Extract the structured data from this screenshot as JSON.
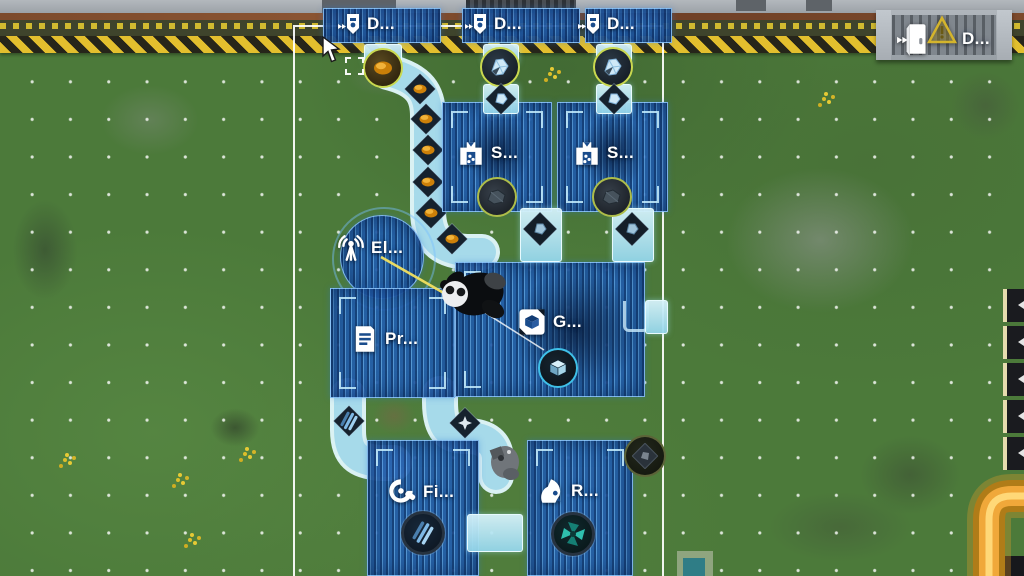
{
  "scene": {
    "view": "factory-blueprint-placement",
    "mode": "blueprint-ghost"
  },
  "labels": {
    "drill_1": "D...",
    "drill_2": "D...",
    "drill_3": "D...",
    "door": "D...",
    "smelter_1": "S...",
    "smelter_2": "S...",
    "electric_pole": "El...",
    "printer": "Pr...",
    "assembler": "G...",
    "fitter": "Fi...",
    "refinery": "R..."
  },
  "icons": {
    "drill": "drill-icon",
    "smelter": "furnace-icon",
    "electric_pole": "antenna-icon",
    "printer": "document-icon",
    "assembler": "cube-transfer-icon",
    "fitter": "gear-icon",
    "refinery": "refine-icon",
    "door": "door-icon",
    "warning": "warning-triangle-icon",
    "cursor": "pointer-cursor-icon"
  },
  "items": {
    "gold_ore": "gold-ore",
    "crystal_ore": "crystal-ore",
    "dark_ingot": "dark-ingot",
    "cube_part": "blue-cube",
    "rods": "blue-rods",
    "fan": "teal-fan"
  },
  "colors": {
    "blueprint_blue": "#2e6cb8",
    "belt_cyan": "#b9e6f2",
    "selection_white": "#ffffff",
    "hazard_yellow": "#e3bf2e",
    "marker_ring_green": "#c9d84f",
    "marker_ring_cyan": "#3fc0e8",
    "ore_gold": "#e0920f",
    "orange_path": "#f2a93c",
    "grass_green": "#4c7a3a"
  }
}
